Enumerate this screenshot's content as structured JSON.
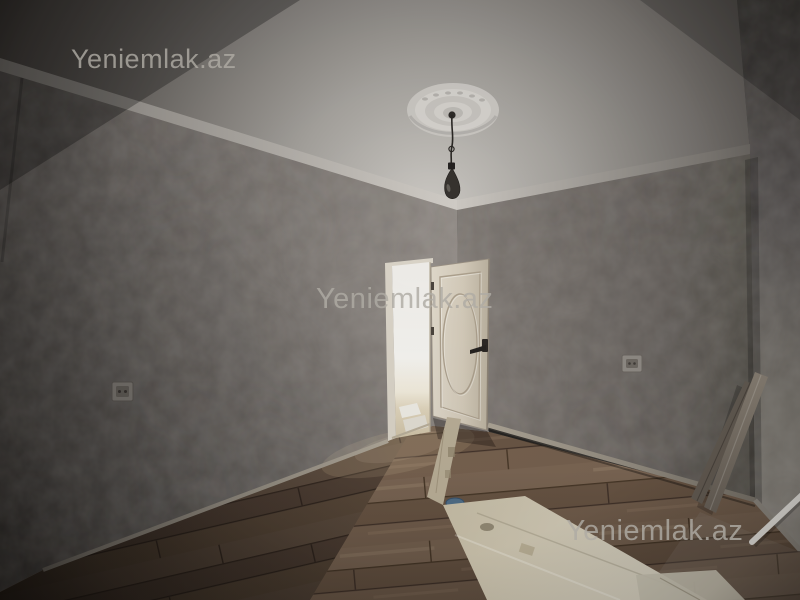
{
  "watermarks": {
    "brand": "Yeniemlak.az",
    "instances": [
      {
        "id": "top-left",
        "text": "Yeniemlak.az"
      },
      {
        "id": "center",
        "text": "Yeniemlak.az"
      },
      {
        "id": "bottom-right",
        "text": "Yeniemlak.az"
      }
    ]
  },
  "scene": {
    "type": "real-estate-interior-photo",
    "subject": "empty room with textured gray wallpaper, white ceiling medallion with hanging bulb, open cream door to bright hallway, laminate wood floor with protective paper strips",
    "palette": {
      "ceiling_light": "#cbc8c3",
      "ceiling_dark": "#3a3733",
      "cornice": "#d0ccc6",
      "wall_left": "#7b7571",
      "wall_right": "#6e6863",
      "wall_right_edge": "#8e8a83",
      "door_leaf": "#d2c9b8",
      "doorway_light": "#f3f2ee",
      "door_handle": "#2c2825",
      "pendant_bulb": "#37332f",
      "floor_mid": "#75604c",
      "floor_dark": "#2e2621",
      "protective_paper": "#cfc8b4",
      "blue_tape": "#4f6d86",
      "white_rod": "#e9e7e2"
    },
    "objects": [
      "ceiling-medallion",
      "pendant-bulb",
      "crown-cornice",
      "open-door",
      "door-handle",
      "doorway-opening",
      "wall-socket-left",
      "wall-socket-right",
      "laminate-floor",
      "protective-paper-strips",
      "leaning-trim-boards",
      "white-rod",
      "baseboards"
    ]
  }
}
